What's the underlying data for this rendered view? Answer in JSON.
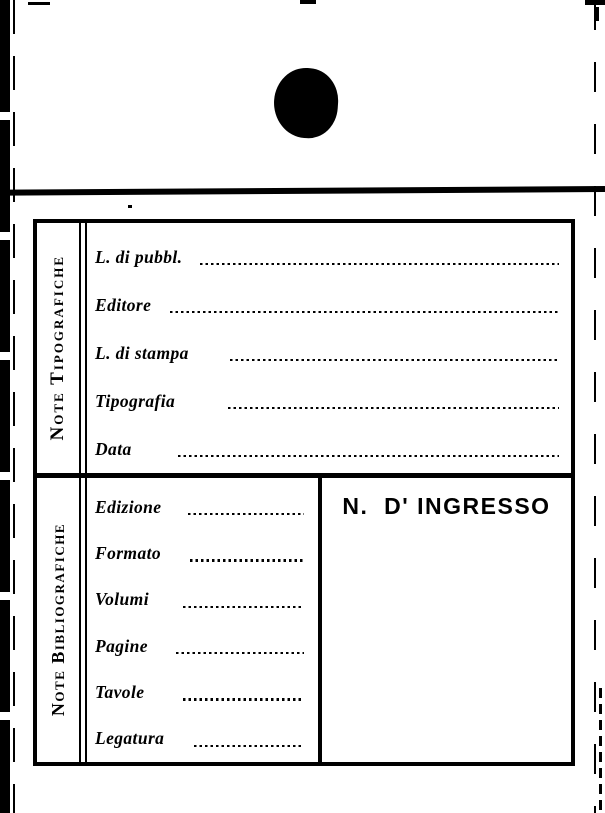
{
  "sections": {
    "tipografiche": {
      "title": "Note Tipografiche",
      "fields": [
        "L. di pubbl.",
        "Editore",
        "L. di stampa",
        "Tipografia",
        "Data"
      ]
    },
    "bibliografiche": {
      "title": "Note Bibliografiche",
      "fields": [
        "Edizione",
        "Formato",
        "Volumi",
        "Pagine",
        "Tavole",
        "Legatura"
      ],
      "ingresso_title": "N.  D' INGRESSO"
    }
  },
  "colors": {
    "ink": "#000000",
    "paper": "#ffffff"
  }
}
